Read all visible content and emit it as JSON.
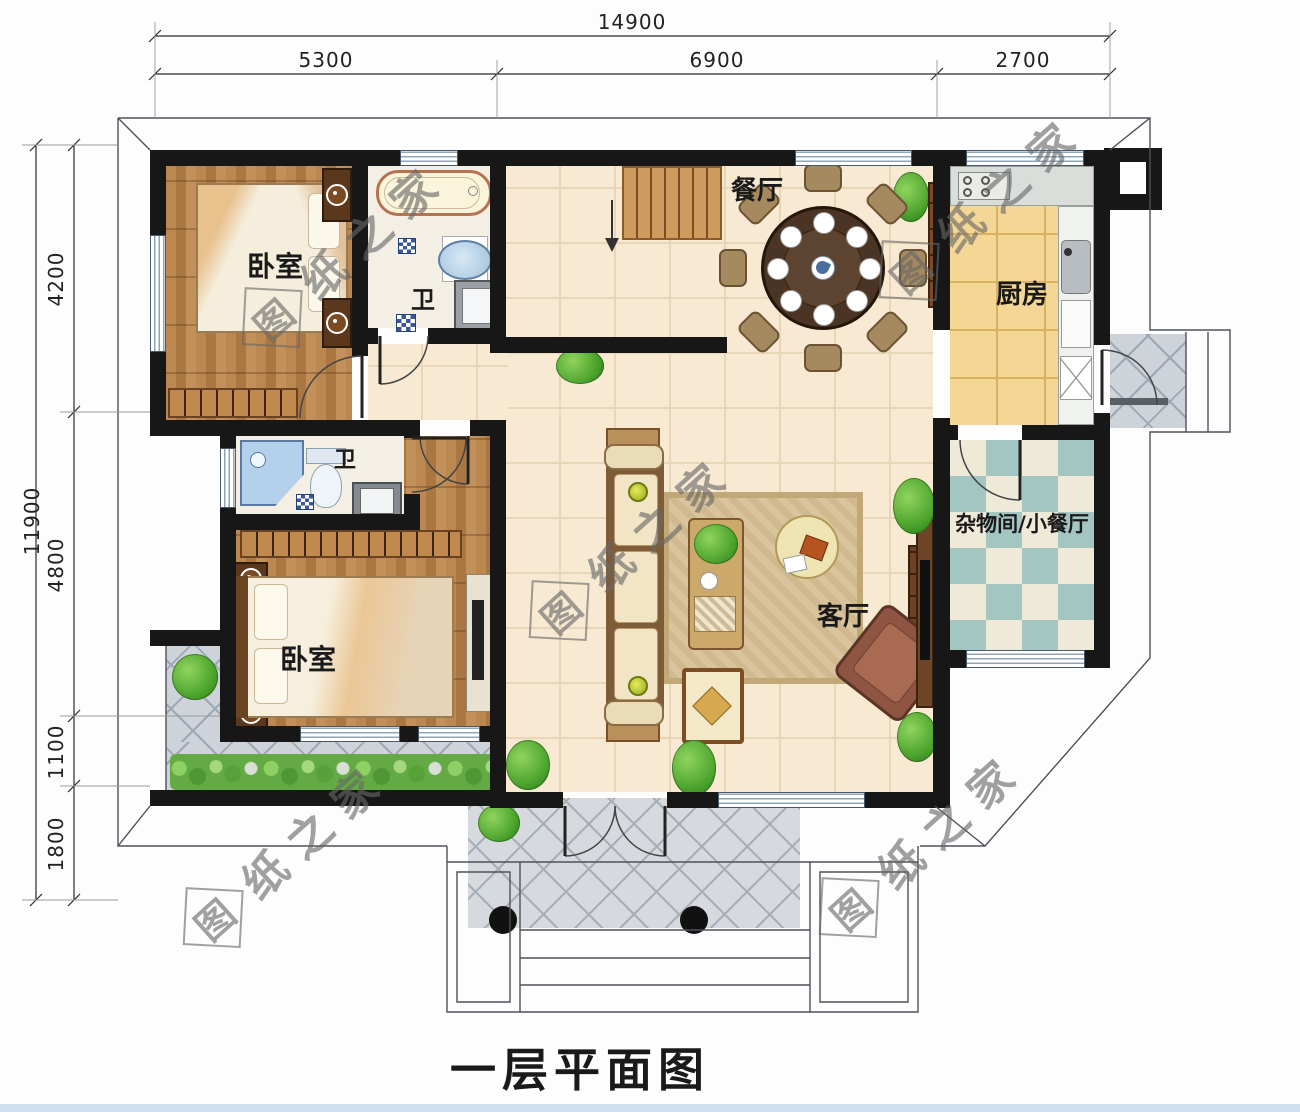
{
  "title": "一层平面图",
  "watermark": {
    "box_char": "图",
    "rest": "纸之家",
    "full": "图纸之家"
  },
  "dimensions": {
    "top": {
      "total": "14900",
      "seg1": "5300",
      "seg2": "6900",
      "seg3": "2700"
    },
    "left": {
      "total": "11900",
      "seg1": "4200",
      "seg2": "4800",
      "seg3": "1100",
      "seg4": "1800"
    }
  },
  "rooms": {
    "bedroom_top": "卧室",
    "bath_top": "卫",
    "dining": "餐厅",
    "kitchen": "厨房",
    "storage_dining": "杂物间/小餐厅",
    "living": "客厅",
    "bedroom_bottom": "卧室",
    "bath_bottom": "卫"
  },
  "colors": {
    "wall": "#171717",
    "tile_floor": "#f8e9d2",
    "wood_floor": "#b9854e",
    "kitchen_floor": "#f4d795",
    "checker_teal": "#a4c6c2",
    "terrace_gray": "#ced3da",
    "dining_table": "#4a3424"
  }
}
